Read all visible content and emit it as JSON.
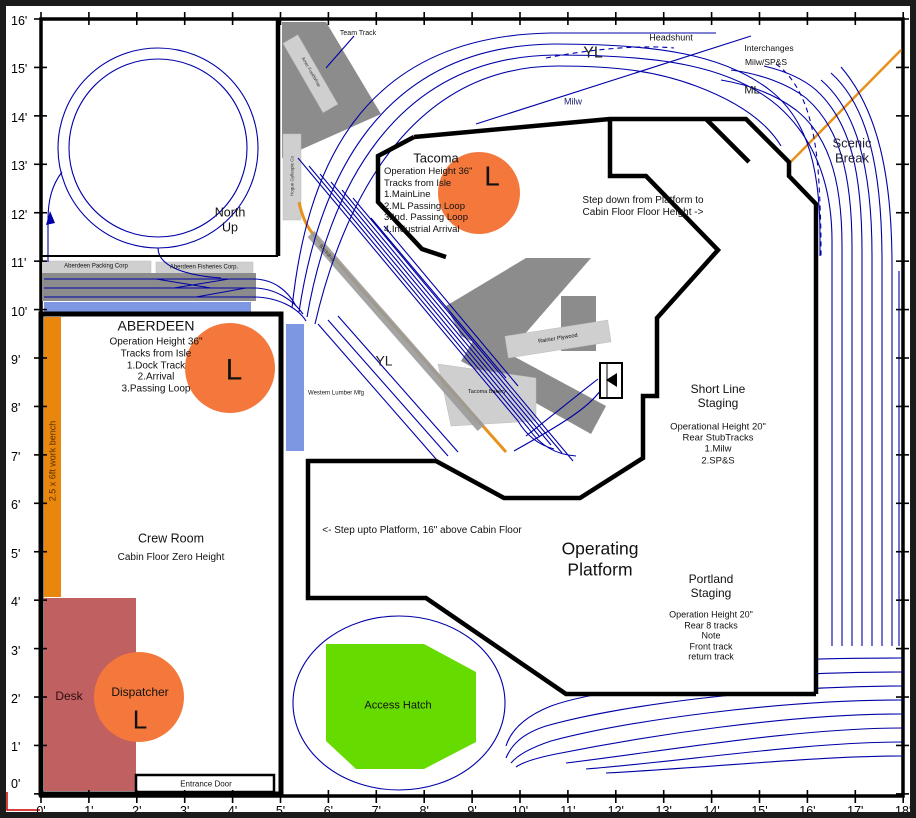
{
  "axes": {
    "left": [
      "16'",
      "15'",
      "14'",
      "13'",
      "12'",
      "11'",
      "10'",
      "9'",
      "8'",
      "7'",
      "6'",
      "5'",
      "4'",
      "3'",
      "2'",
      "1'"
    ],
    "left_origin": "0'",
    "bottom": [
      "0'",
      "1'",
      "2'",
      "3'",
      "4'",
      "5'",
      "6'",
      "7'",
      "8'",
      "9'",
      "10'",
      "11'",
      "12'",
      "13'",
      "14'",
      "15'",
      "16'",
      "17'",
      "18'"
    ]
  },
  "compass": {
    "north": "North\nUp"
  },
  "track_labels": {
    "team_track": "Team Track",
    "yl_top": "YL",
    "yl_mid": "YL",
    "headshunt": "Headshunt",
    "interchanges": "Interchanges",
    "interchange_roads": "Milw/SP&S",
    "ml": "ML",
    "milw": "Milw",
    "scenic_break": "Scenic Break"
  },
  "towns": {
    "tacoma": {
      "title": "Tacoma",
      "details": "Operation Height 36\"\nTracks from Isle\n1.MainLine\n2.ML Passing Loop\n3.Ind. Passing Loop\n4.Industrial Arrival",
      "light": "L"
    },
    "aberdeen": {
      "title": "ABERDEEN",
      "details": "Operation Height 36\"\nTracks from Isle\n1.Dock Track\n2.Arrival\n3.Passing Loop",
      "light": "L"
    }
  },
  "staging": {
    "short_line": {
      "title": "Short Line\nStaging",
      "details": "Operational Height 20\"\nRear StubTracks\n1.Milw\n2.SP&S"
    },
    "portland": {
      "title": "Portland\nStaging",
      "details": "Operation Height 20\"\nRear 8 tracks\nNote\nFront track\nreturn track"
    }
  },
  "platform": {
    "label": "Operating\nPlatform",
    "step_down": "Step down from Platform to\nCabin Floor Floor Height ->",
    "step_up": "<- Step upto Platform, 16\" above Cabin Floor"
  },
  "crew_room": {
    "title": "Crew Room",
    "subtitle": "Cabin Floor Zero Height",
    "desk": "Desk",
    "dispatcher": "Dispatcher",
    "dispatcher_light": "L",
    "work_bench": "2.5 x 6ft work bench",
    "entrance_door": "Entrance Door"
  },
  "access_hatch": "Access Hatch",
  "industries": {
    "packing": "Aberdeen Packing Corp",
    "fisheries": "Aberdeen Fisheries Corp.",
    "western_lumber": "Western Lumber Mfg",
    "bakery": "Tacoma Bakery",
    "plywood": "Rainier Plywood",
    "fuel_whse": "Amer Fuel/Whse",
    "gyllespie": "Hogue Gyllespie Co",
    "backdrop": "Backdrop"
  },
  "colors": {
    "track": "#0000A8",
    "benchwork": "#000000",
    "light_circle": "#F4783B",
    "work_bench": "#E8860D",
    "desk": "#C06060",
    "access_hatch": "#66DB00",
    "water": "#7D97E3",
    "structure_dark": "#8C8C8C",
    "structure_light": "#CFCFCF",
    "scenic_break_line": "#E8921E",
    "origin_mark": "#CC0000"
  }
}
